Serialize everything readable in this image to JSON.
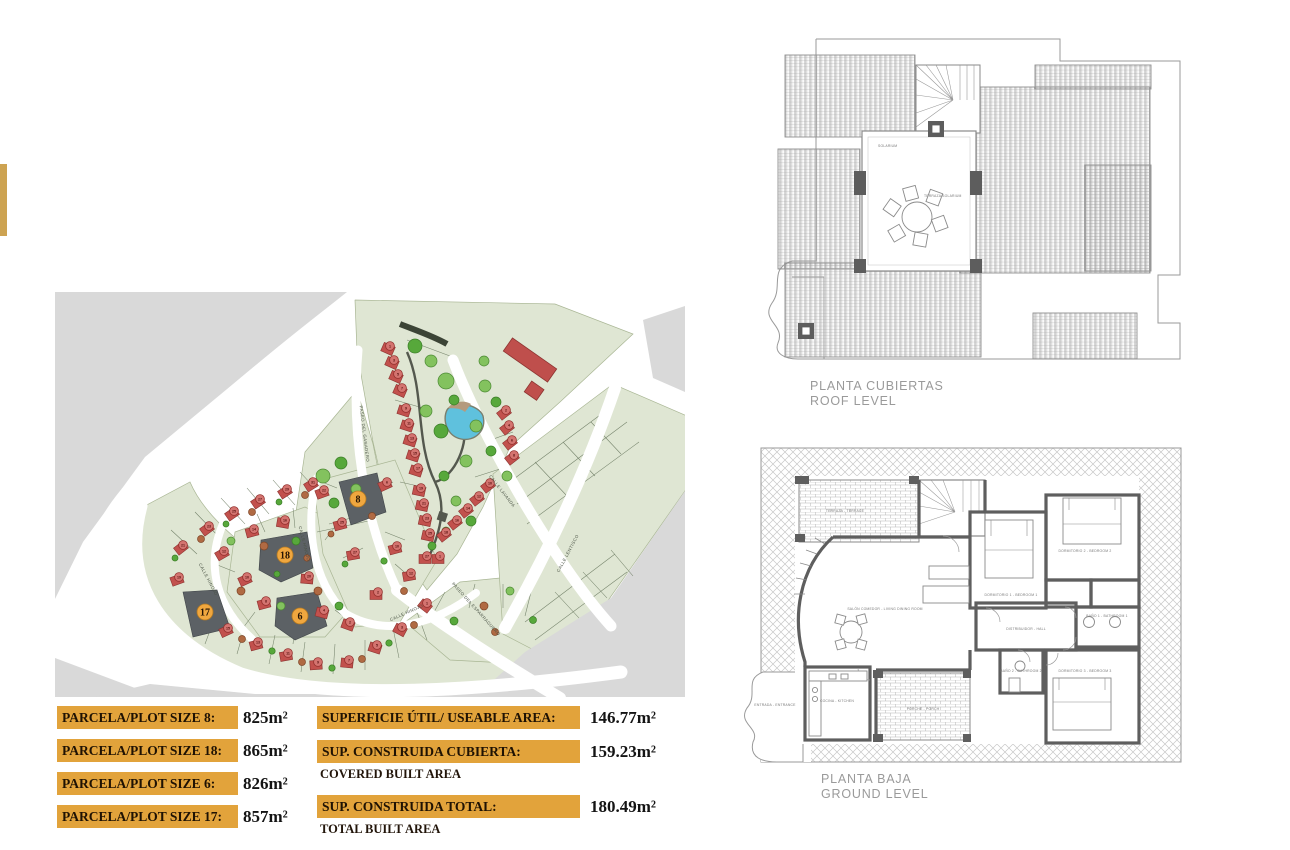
{
  "accent_bar": {
    "color": "#CDA352"
  },
  "plot_table": {
    "rows": [
      {
        "label": "PARCELA/PLOT SIZE 8:",
        "value": "825m²"
      },
      {
        "label": "PARCELA/PLOT SIZE 18:",
        "value": "865m²"
      },
      {
        "label": "PARCELA/PLOT SIZE 6:",
        "value": "826m²"
      },
      {
        "label": "PARCELA/PLOT SIZE 17:",
        "value": "857m²"
      }
    ],
    "bar_color": "#E2A33B"
  },
  "area_table": {
    "rows": [
      {
        "label": "SUPERFICIE ÚTIL/ USEABLE AREA:",
        "value": "146.77m²",
        "sublabel": ""
      },
      {
        "label": "SUP. CONSTRUIDA CUBIERTA:",
        "value": "159.23m²",
        "sublabel": "COVERED BUILT AREA"
      },
      {
        "label": "SUP. CONSTRUIDA TOTAL:",
        "value": "180.49m²",
        "sublabel": "TOTAL BUILT AREA"
      }
    ],
    "bar_color": "#E2A33B"
  },
  "roof_plan": {
    "title": "PLANTA CUBIERTAS",
    "subtitle": "ROOF LEVEL",
    "labels": {
      "solarium": "SOLARIUM",
      "terraza": "TERRAZA SOLARIUM"
    }
  },
  "ground_plan": {
    "title": "PLANTA BAJA",
    "subtitle": "GROUND LEVEL",
    "rooms": {
      "living": "SALÓN COMEDOR - LIVING DINING ROOM",
      "hall": "DISTRIBUIDOR - HALL",
      "bed1": "DORMITORIO 1 - BEDROOM 1",
      "bed2": "DORMITORIO 2 - BEDROOM 2",
      "bed3": "DORMITORIO 3 - BEDROOM 3",
      "bath1": "BAÑO 1 - BATHROOM 1",
      "bath2": "BAÑO 2 - BATHROOM 2",
      "kitchen": "COCINA - KITCHEN",
      "terrace": "TERRAZA - TERRACE",
      "porch": "PORCHE - PORCH",
      "entrance": "ENTRADA - ENTRANCE"
    }
  },
  "site_plan": {
    "colors": {
      "green": "#dfe6d3",
      "green_line": "#a9b694",
      "gray": "#d9d9d9",
      "house": "#c2514d",
      "house_line": "#8c3330",
      "circle": "#d47470",
      "circle_line": "#93302d",
      "plot_dark": "#5c6165",
      "plot_circle": "#f0a73f",
      "pond": "#5fc1dd",
      "path": "#54584e"
    },
    "street_labels": [
      [
        "PASEO DEL GANADERO",
        308,
        142,
        83
      ],
      [
        "CALLE HINOJO",
        248,
        252,
        76
      ],
      [
        "CALLE HINOJO",
        152,
        288,
        62
      ],
      [
        "CALLE HINOJO",
        352,
        322,
        -24
      ],
      [
        "CALLE LAVANDA",
        446,
        200,
        52
      ],
      [
        "CALLE LENTISCO",
        514,
        262,
        -62
      ],
      [
        "PASEO DEL ESPARRAGUERO",
        420,
        318,
        48
      ]
    ],
    "highlighted_plots": [
      {
        "number": "8",
        "x": 303,
        "y": 207
      },
      {
        "number": "18",
        "x": 230,
        "y": 263
      },
      {
        "number": "6",
        "x": 245,
        "y": 324
      },
      {
        "number": "17",
        "x": 150,
        "y": 320
      }
    ],
    "houses": [
      [
        333,
        57,
        24,
        "1"
      ],
      [
        337,
        71,
        24,
        "3"
      ],
      [
        341,
        85,
        24,
        "5"
      ],
      [
        345,
        99,
        24,
        "7"
      ],
      [
        349,
        119,
        18,
        "9"
      ],
      [
        352,
        134,
        18,
        "11"
      ],
      [
        355,
        149,
        18,
        "13"
      ],
      [
        358,
        164,
        18,
        "15"
      ],
      [
        361,
        179,
        18,
        "17"
      ],
      [
        364,
        199,
        12,
        "19"
      ],
      [
        367,
        214,
        12,
        "21"
      ],
      [
        370,
        229,
        12,
        "23"
      ],
      [
        373,
        244,
        12,
        "25"
      ],
      [
        449,
        121,
        -38,
        "2"
      ],
      [
        452,
        136,
        -38,
        "4"
      ],
      [
        455,
        151,
        -38,
        "6"
      ],
      [
        457,
        166,
        -38,
        "8"
      ],
      [
        433,
        194,
        -38,
        "10"
      ],
      [
        422,
        207,
        -38,
        "12"
      ],
      [
        411,
        219,
        -38,
        "14"
      ],
      [
        400,
        231,
        -38,
        "16"
      ],
      [
        389,
        243,
        -38,
        "18"
      ],
      [
        370,
        267,
        0,
        "27"
      ],
      [
        383,
        267,
        0,
        "1"
      ],
      [
        256,
        193,
        -32,
        "31"
      ],
      [
        230,
        200,
        -33,
        "29"
      ],
      [
        203,
        210,
        -34,
        "27"
      ],
      [
        177,
        222,
        -35,
        "25"
      ],
      [
        152,
        237,
        -36,
        "23"
      ],
      [
        126,
        256,
        -38,
        "21"
      ],
      [
        122,
        288,
        -20,
        "19"
      ],
      [
        171,
        339,
        -25,
        "15"
      ],
      [
        201,
        353,
        -15,
        "13"
      ],
      [
        231,
        364,
        -10,
        "11"
      ],
      [
        261,
        373,
        -4,
        "9"
      ],
      [
        292,
        371,
        6,
        "7"
      ],
      [
        320,
        356,
        18,
        "5"
      ],
      [
        345,
        338,
        28,
        "3"
      ],
      [
        370,
        314,
        38,
        "1"
      ],
      [
        228,
        231,
        10,
        "16"
      ],
      [
        197,
        240,
        -15,
        "14"
      ],
      [
        167,
        262,
        -30,
        "12"
      ],
      [
        190,
        288,
        -25,
        "10"
      ],
      [
        209,
        312,
        -15,
        "8"
      ],
      [
        252,
        287,
        5,
        "20"
      ],
      [
        267,
        321,
        15,
        "4"
      ],
      [
        293,
        333,
        20,
        "2"
      ],
      [
        267,
        201,
        -20,
        "22"
      ],
      [
        285,
        233,
        -15,
        "25"
      ],
      [
        298,
        263,
        -10,
        "27"
      ],
      [
        330,
        193,
        -25,
        "6"
      ],
      [
        340,
        257,
        -15,
        "10"
      ],
      [
        354,
        284,
        -10,
        "12"
      ],
      [
        321,
        303,
        0,
        "2"
      ]
    ],
    "trees": [
      [
        360,
        54,
        7,
        1
      ],
      [
        376,
        69,
        6,
        0
      ],
      [
        391,
        89,
        8,
        0
      ],
      [
        399,
        108,
        5,
        1
      ],
      [
        371,
        119,
        6,
        0
      ],
      [
        386,
        139,
        7,
        1
      ],
      [
        430,
        94,
        6,
        0
      ],
      [
        441,
        110,
        5,
        1
      ],
      [
        421,
        134,
        6,
        0
      ],
      [
        436,
        159,
        5,
        1
      ],
      [
        411,
        169,
        6,
        0
      ],
      [
        389,
        184,
        5,
        1
      ],
      [
        401,
        209,
        5,
        0
      ],
      [
        416,
        229,
        5,
        1
      ],
      [
        391,
        239,
        4,
        0
      ],
      [
        377,
        254,
        4,
        1
      ],
      [
        452,
        184,
        5,
        0
      ],
      [
        429,
        69,
        5,
        0
      ],
      [
        268,
        184,
        7,
        0
      ],
      [
        286,
        171,
        6,
        1
      ],
      [
        301,
        197,
        5,
        0
      ],
      [
        279,
        211,
        5,
        1
      ],
      [
        176,
        249,
        4,
        0
      ],
      [
        209,
        254,
        4,
        2
      ],
      [
        241,
        249,
        4,
        1
      ],
      [
        186,
        299,
        4,
        2
      ],
      [
        226,
        314,
        4,
        0
      ],
      [
        263,
        299,
        4,
        2
      ],
      [
        284,
        314,
        4,
        1
      ],
      [
        250,
        203,
        3.5,
        2
      ],
      [
        224,
        210,
        3,
        1
      ],
      [
        197,
        220,
        3.5,
        2
      ],
      [
        171,
        232,
        3,
        1
      ],
      [
        146,
        247,
        3.5,
        2
      ],
      [
        120,
        266,
        3,
        1
      ],
      [
        187,
        347,
        3.5,
        2
      ],
      [
        217,
        359,
        3.2,
        1
      ],
      [
        247,
        370,
        3.5,
        2
      ],
      [
        277,
        376,
        3.2,
        1
      ],
      [
        307,
        367,
        3.5,
        2
      ],
      [
        334,
        351,
        3.2,
        1
      ],
      [
        359,
        333,
        3.5,
        2
      ],
      [
        317,
        224,
        3.5,
        2
      ],
      [
        329,
        269,
        3.2,
        1
      ],
      [
        349,
        299,
        3.5,
        2
      ],
      [
        276,
        242,
        3,
        2
      ],
      [
        290,
        272,
        3,
        1
      ],
      [
        399,
        329,
        4,
        1
      ],
      [
        429,
        314,
        4,
        2
      ],
      [
        455,
        299,
        4,
        0
      ],
      [
        478,
        328,
        3.5,
        1
      ],
      [
        440,
        340,
        3.5,
        2
      ],
      [
        252,
        266,
        3.2,
        2
      ],
      [
        222,
        282,
        3,
        1
      ]
    ]
  }
}
